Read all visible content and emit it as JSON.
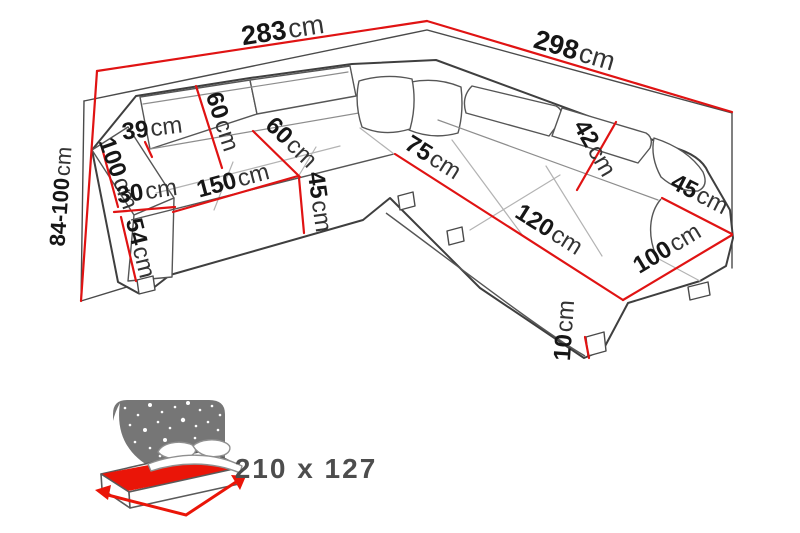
{
  "diagram_type": "corner-sofa-dimension-drawing",
  "colors": {
    "dimension_red": "#e01313",
    "mattress_red": "#ea1508",
    "outline_gray": "#3f3f3f",
    "headboard_gray": "#767676",
    "sleep_text_gray": "#4d4d4d"
  },
  "dimensions": [
    {
      "name": "total-width-left",
      "value": "283",
      "unit": "cm"
    },
    {
      "name": "total-width-right",
      "value": "298",
      "unit": "cm"
    },
    {
      "name": "height-range",
      "value": "84-100",
      "unit": "cm"
    },
    {
      "name": "backrest-top",
      "value": "39",
      "unit": "cm"
    },
    {
      "name": "headrest-left",
      "value": "60",
      "unit": "cm"
    },
    {
      "name": "armrest-left-depth",
      "value": "100",
      "unit": "cm"
    },
    {
      "name": "armrest-left-width",
      "value": "30",
      "unit": "cm"
    },
    {
      "name": "armrest-left-height",
      "value": "54",
      "unit": "cm"
    },
    {
      "name": "seat-length-left",
      "value": "150",
      "unit": "cm"
    },
    {
      "name": "seat-depth",
      "value": "60",
      "unit": "cm"
    },
    {
      "name": "seat-height",
      "value": "45",
      "unit": "cm"
    },
    {
      "name": "corner-seat-width",
      "value": "75",
      "unit": "cm"
    },
    {
      "name": "chaise-length",
      "value": "120",
      "unit": "cm"
    },
    {
      "name": "headrest-right",
      "value": "42",
      "unit": "cm"
    },
    {
      "name": "armrest-right-width",
      "value": "45",
      "unit": "cm"
    },
    {
      "name": "chaise-width",
      "value": "100",
      "unit": "cm"
    },
    {
      "name": "leg-height",
      "value": "10",
      "unit": "cm"
    }
  ],
  "sleeping_area": {
    "value": "210 x 127"
  }
}
